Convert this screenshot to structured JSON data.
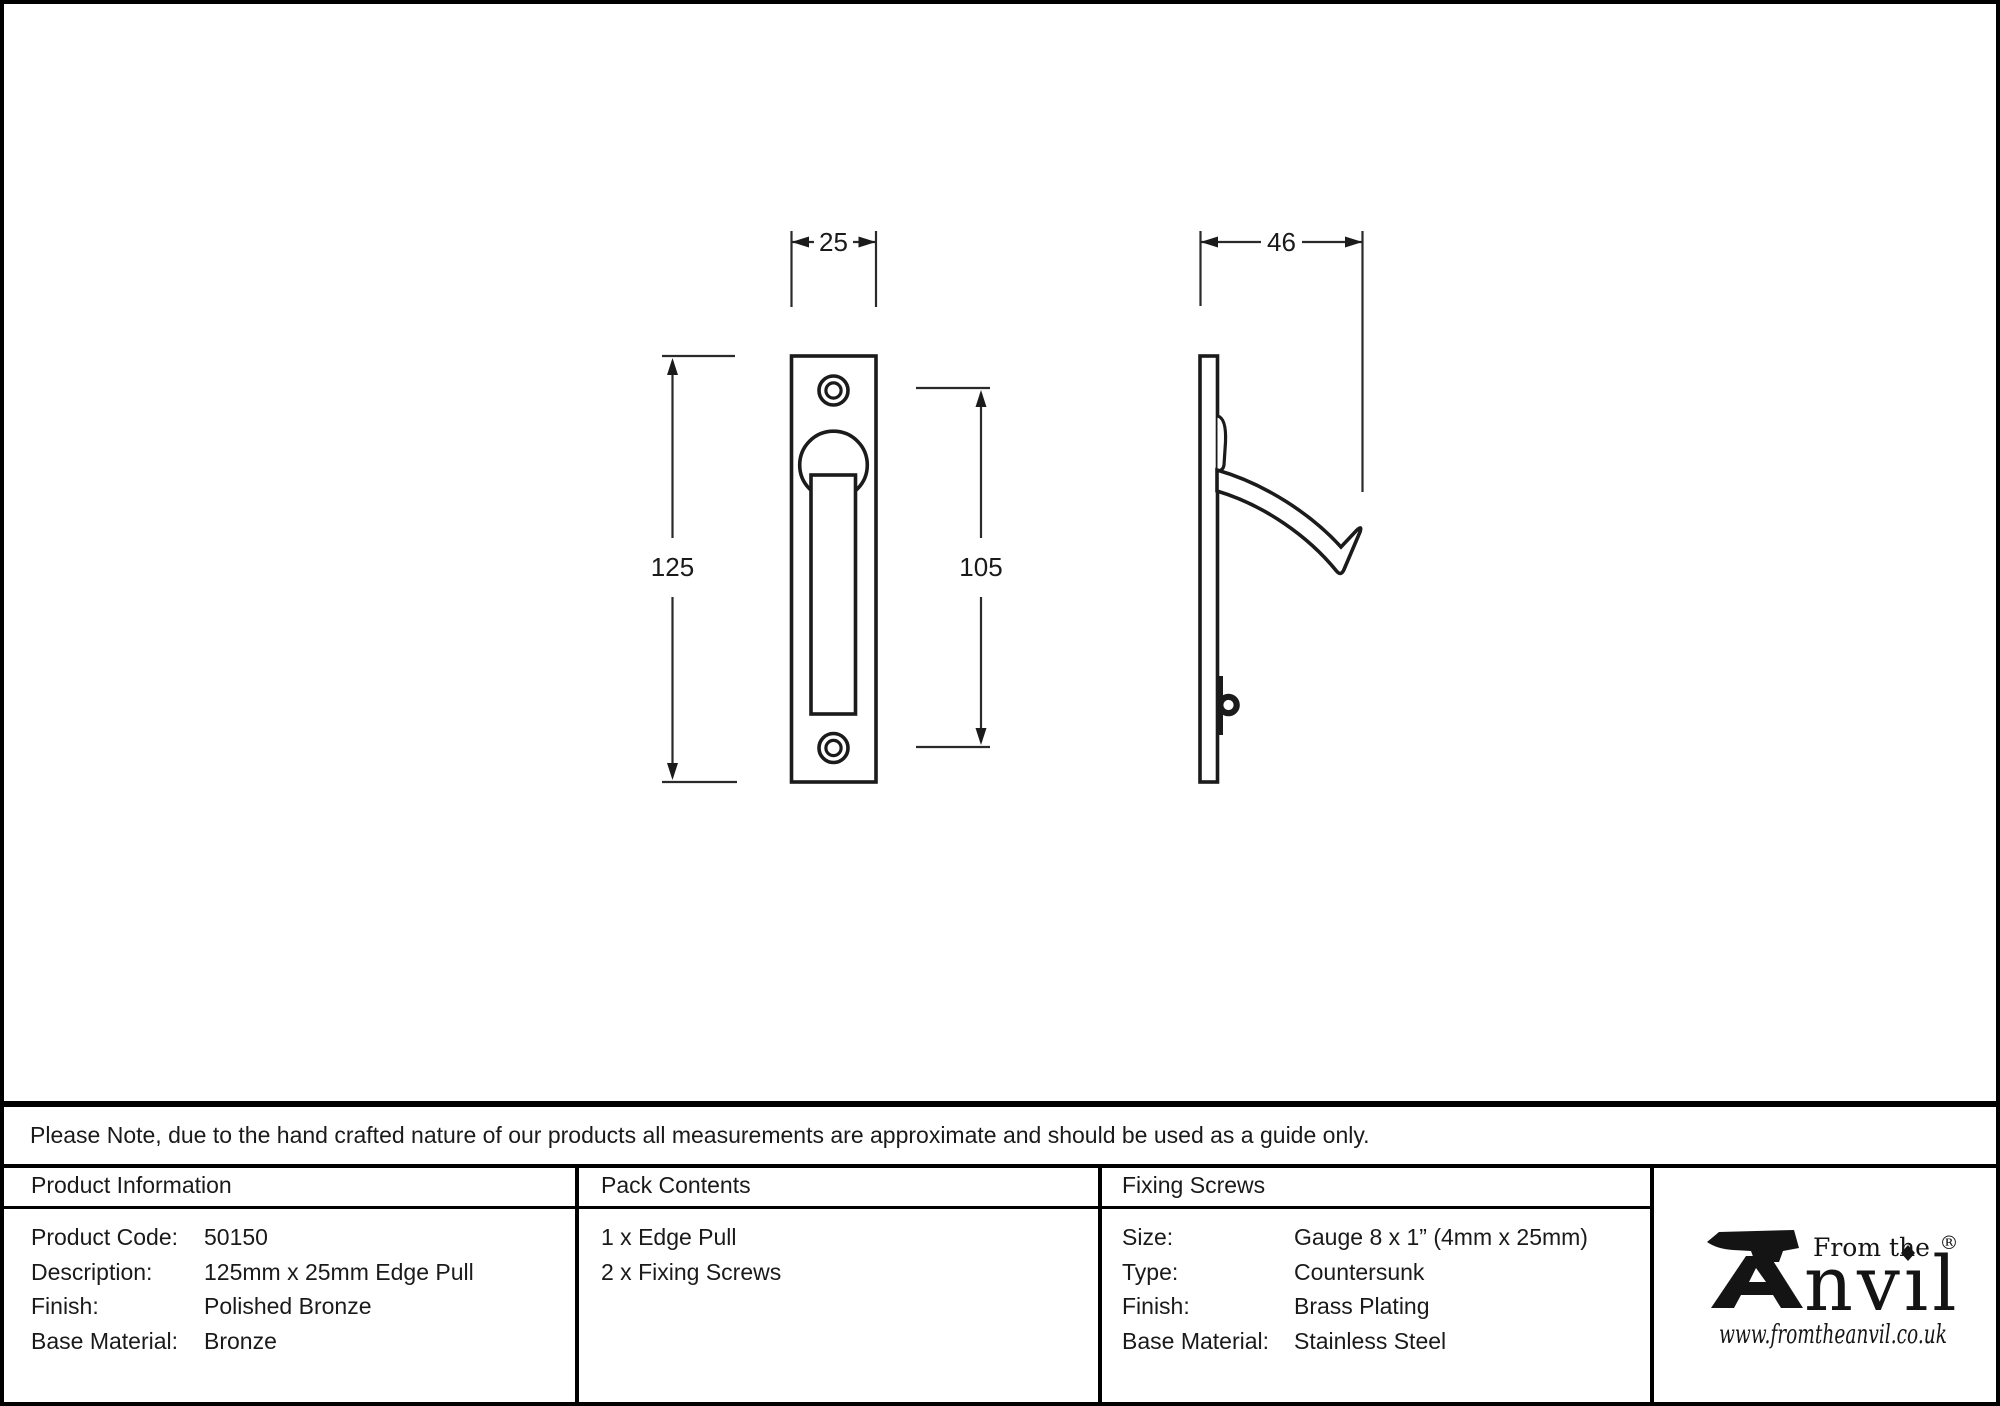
{
  "page": {
    "background": "#ffffff",
    "line_color": "#1a1a1a"
  },
  "drawing": {
    "front_view": {
      "width_mm": "25",
      "height_mm": "125",
      "screw_spacing_mm": "105"
    },
    "side_view": {
      "depth_mm": "46"
    }
  },
  "note": {
    "text": "Please Note, due to the hand crafted nature of our products all measurements are approximate and should be used as a guide only."
  },
  "table": {
    "product_information": {
      "header": "Product Information",
      "rows": [
        {
          "label": "Product Code:",
          "value": "50150"
        },
        {
          "label": "Description:",
          "value": "125mm x 25mm Edge Pull"
        },
        {
          "label": "Finish:",
          "value": "Polished Bronze"
        },
        {
          "label": "Base Material:",
          "value": "Bronze"
        }
      ]
    },
    "pack_contents": {
      "header": "Pack Contents",
      "items": [
        "1 x Edge Pull",
        "2 x Fixing Screws"
      ]
    },
    "fixing_screws": {
      "header": "Fixing Screws",
      "rows": [
        {
          "label": "Size:",
          "value": "Gauge 8 x 1” (4mm x 25mm)"
        },
        {
          "label": "Type:",
          "value": "Countersunk"
        },
        {
          "label": "Finish:",
          "value": "Brass Plating"
        },
        {
          "label": "Base Material:",
          "value": "Stainless Steel"
        }
      ]
    }
  },
  "logo": {
    "tagline": "From the",
    "brand": "Anvil",
    "brand_suffix": "nvıl",
    "registered": "®",
    "website": "www.fromtheanvil.co.uk"
  }
}
